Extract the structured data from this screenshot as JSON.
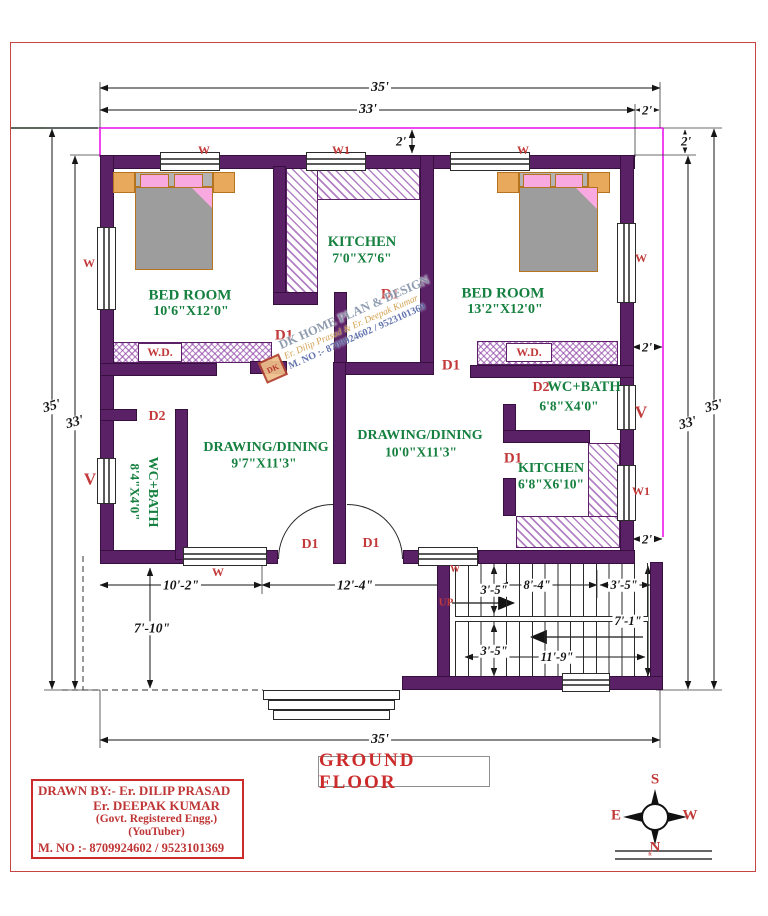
{
  "plan": {
    "title": "GROUND FLOOR",
    "rooms": [
      {
        "name": "BED ROOM",
        "size": "10'6\"X12'0\""
      },
      {
        "name": "KITCHEN",
        "size": "7'0\"X7'6\""
      },
      {
        "name": "BED ROOM",
        "size": "13'2\"X12'0\""
      },
      {
        "name": "WC+BATH",
        "size": "8'4\"X4'0\""
      },
      {
        "name": "DRAWING/DINING",
        "size": "9'7\"X11'3\""
      },
      {
        "name": "DRAWING/DINING",
        "size": "10'0\"X11'3\""
      },
      {
        "name": "WC+BATH",
        "size": "6'8\"X4'0\""
      },
      {
        "name": "KITCHEN",
        "size": "6'8\"X6'10\""
      }
    ],
    "openings": {
      "door1": "D1",
      "door2": "D2",
      "window": "W",
      "window1": "W1",
      "vent": "V",
      "wardrobe": "W.D.",
      "up": "UP"
    },
    "dimensions": {
      "overall_width": "35'",
      "inner_width": "33'",
      "offset": "2'",
      "overall_height": "35'",
      "inner_height": "33'",
      "porch_width": "10'-2\"",
      "entry_width": "12'-4\"",
      "porch_depth": "7'-10\"",
      "stair_width_a": "3'-5\"",
      "stair_run": "8'-4\"",
      "stair_width_b": "3'-5\"",
      "stair_depth": "7'-1\"",
      "stair_width_c": "3'-5\"",
      "stair_length": "11'-9\""
    }
  },
  "watermark": {
    "logo": "DK",
    "brand": "DK HOME PLAN & DESIGN",
    "authors": "Er. Dilip Prasad & Er. Deepak Kumar",
    "mobile": "M. NO :- 8709924602 / 9523101369"
  },
  "info_box": {
    "drawn_by": "DRAWN BY:-  Er. DILIP PRASAD",
    "author2": "Er. DEEPAK KUMAR",
    "credential": "(Govt. Registered Engg.)",
    "credential2": "(YouTuber)",
    "mobile": "M. NO :- 8709924602 / 9523101369"
  },
  "compass": {
    "north": "N",
    "south": "S",
    "east": "E",
    "west": "W",
    "scale_label": "ft"
  },
  "colors": {
    "wall": "#5b2167",
    "offset_line": "#ee2fee",
    "accent_red": "#c23a3a",
    "room_green": "#15803f"
  }
}
